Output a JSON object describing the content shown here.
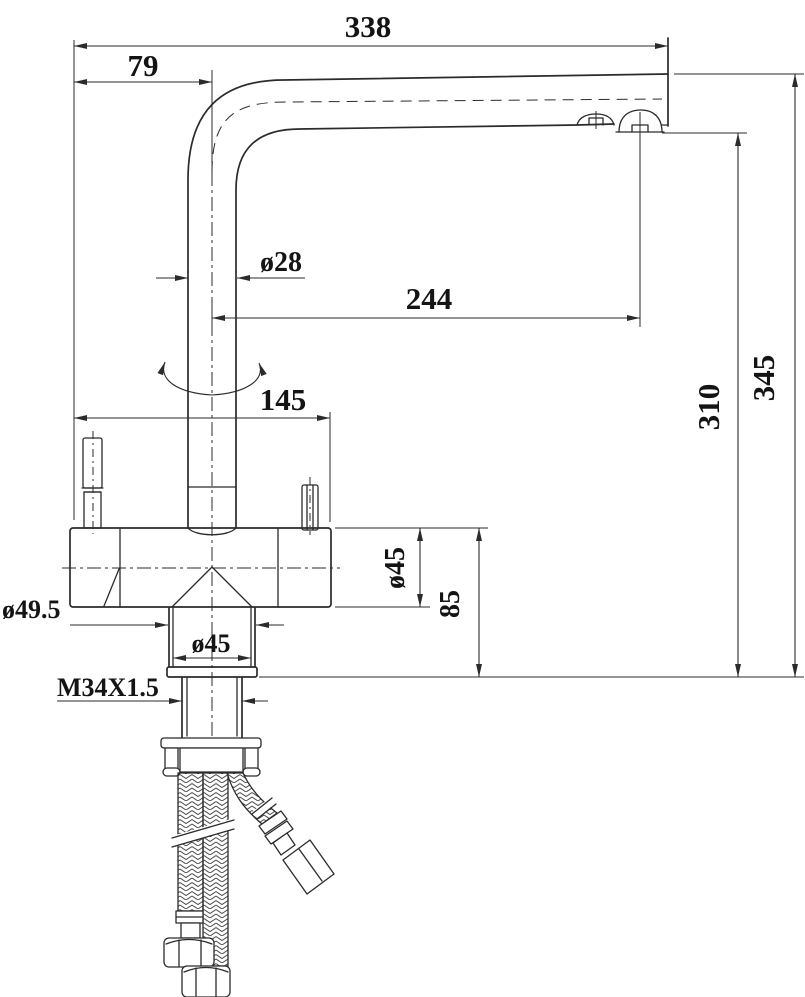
{
  "colors": {
    "background": "#ffffff",
    "line": "#2b2b2b",
    "text": "#141414"
  },
  "dimensions": {
    "spout_reach": "338",
    "spout_offset": "79",
    "spout_tube_diameter": "ø28",
    "aerator_offset": "244",
    "body_width": "145",
    "total_height": "345",
    "spout_height": "310",
    "body_diameter": "ø45",
    "base_height": "85",
    "base_outer_diameter": "ø49.5",
    "base_skirt_diameter": "ø45",
    "mounting_thread": "M34X1.5"
  }
}
